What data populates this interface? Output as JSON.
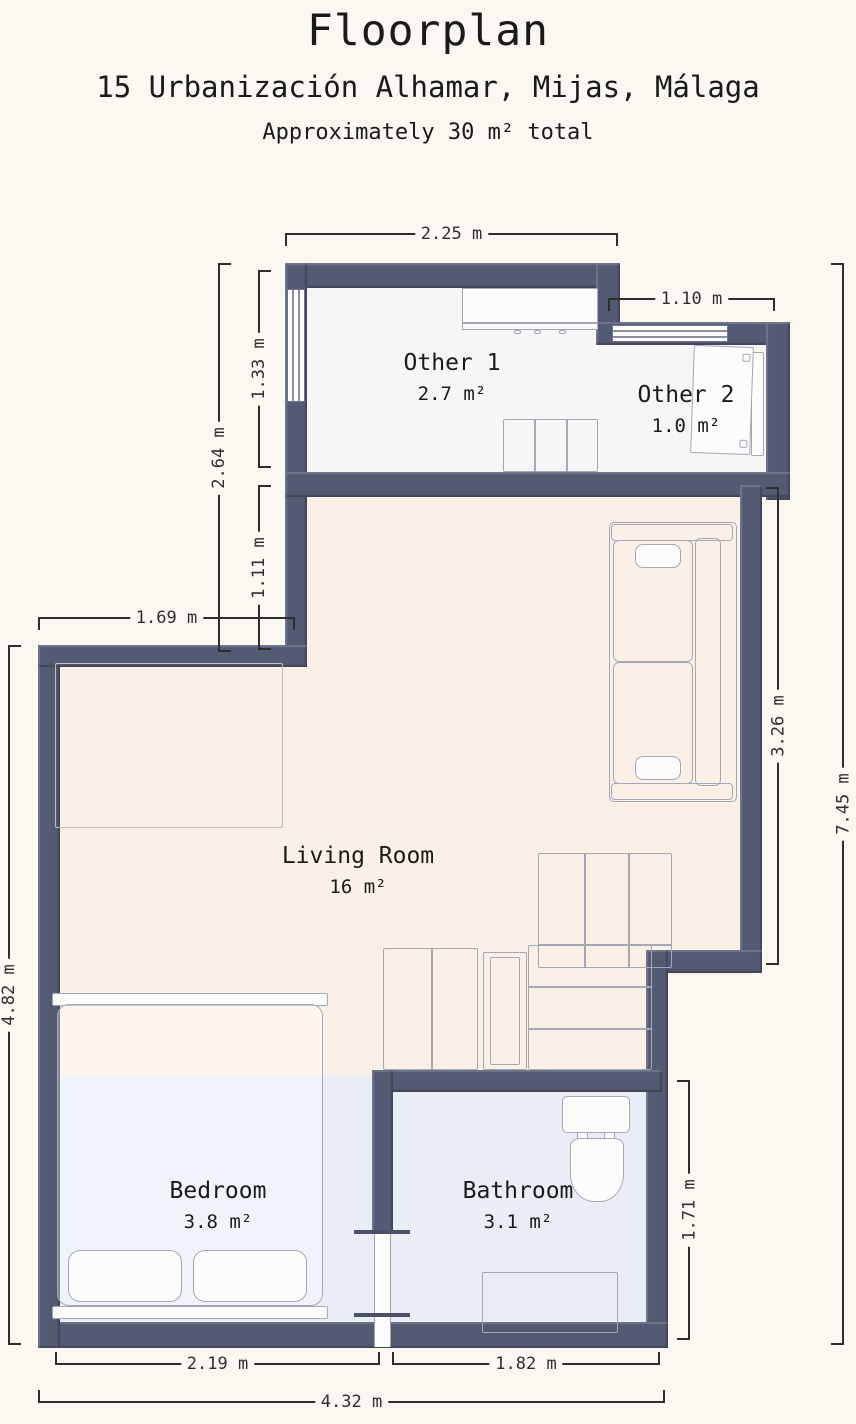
{
  "header": {
    "title": "Floorplan",
    "address": "15 Urbanización Alhamar, Mijas, Málaga",
    "area_note": "Approximately 30 m² total"
  },
  "rooms": {
    "other1": {
      "name": "Other 1",
      "area": "2.7 m²"
    },
    "other2": {
      "name": "Other 2",
      "area": "1.0 m²"
    },
    "living": {
      "name": "Living Room",
      "area": "16 m²"
    },
    "bedroom": {
      "name": "Bedroom",
      "area": "3.8 m²"
    },
    "bathroom": {
      "name": "Bathroom",
      "area": "3.1 m²"
    }
  },
  "dimensions": {
    "other1_width": "2.25 m",
    "other2_width": "1.10 m",
    "other1_height": "1.33 m",
    "upper_left_total": "2.64 m",
    "step_height": "1.11 m",
    "step_width": "1.69 m",
    "lower_left_height": "4.82 m",
    "living_right_height": "3.26 m",
    "total_height": "7.45 m",
    "bathroom_height": "1.71 m",
    "bedroom_width": "2.19 m",
    "bathroom_width": "1.82 m",
    "total_width": "4.32 m"
  },
  "colors": {
    "bg": "#faf8f1",
    "wall": "#545a73",
    "floor_other": "#f6f6f7",
    "floor_living": "#faf0e8",
    "floor_wet": "#e9edf6",
    "dim": "#2e2e2e",
    "furn": "#a3a8b4",
    "text": "#1a1a1a"
  }
}
